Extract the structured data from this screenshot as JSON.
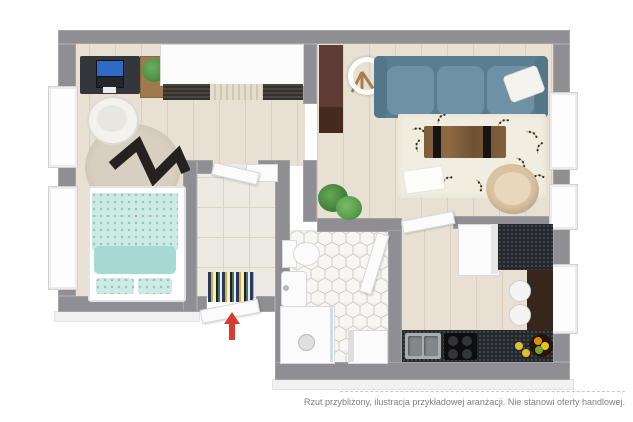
{
  "caption": {
    "text": "Rzut przybliżony, ilustracja przykładowej aranżacji. Nie stanowi oferty handlowej."
  },
  "entrance_marker": {
    "icon": "arrow-up-icon",
    "color": "#d43c30"
  },
  "colors": {
    "wall": "#8f8f93",
    "floor_wood": "#e8e1d3",
    "floor_tile": "#edebe1",
    "hex_tile": "#f7f6f3",
    "sofa": "#5b7d92",
    "sofa_cushion": "#6e91a5",
    "bed": "#cdeae4",
    "bed_blanket": "#a6d9d4",
    "counter": "#24272b",
    "bar_wood": "#37261c",
    "cabinet_brown": "#5e3c35",
    "coffee_table_wood": "#82603c",
    "rug_living": "#f2ede1",
    "rug_bedroom": "#d9cfc0",
    "armchair": "#d8c2a0",
    "desk": "#33363b",
    "laptop_screen": "#2e6ac6",
    "plant_green": "#4e8f45",
    "accent_red": "#d43c30"
  }
}
